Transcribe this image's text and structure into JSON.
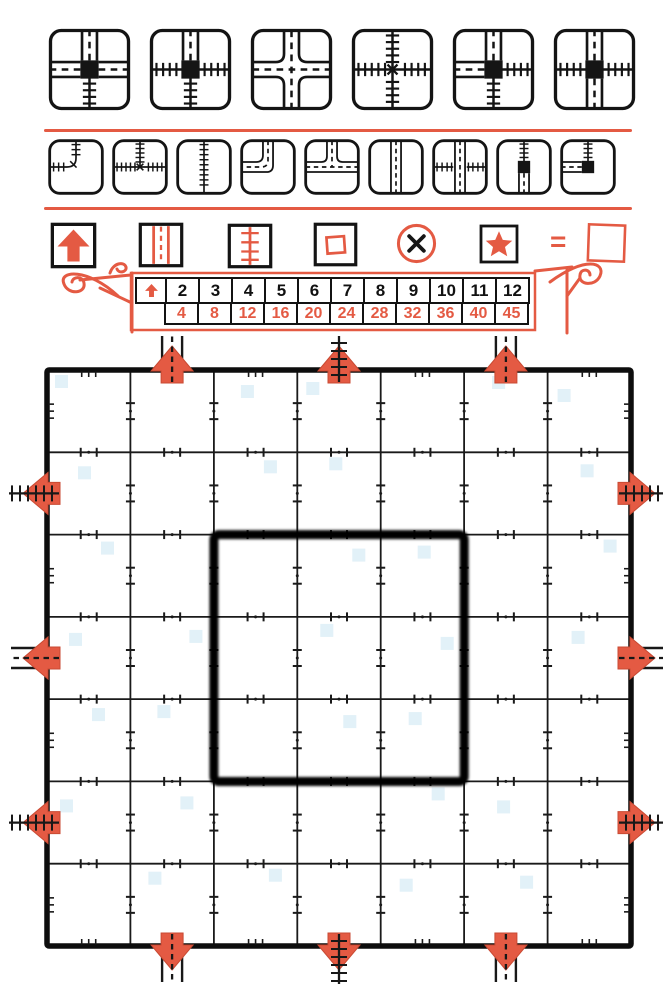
{
  "colors": {
    "red": "#e45a43",
    "red_dark": "#c94a33",
    "ink": "#141414",
    "artifact_blue": "#d6ebf5"
  },
  "labels": {
    "equals": "="
  },
  "special_tiles": [
    {
      "name": "station-3highway-1rail",
      "edges": {
        "top": "highway",
        "left": "highway",
        "right": "highway",
        "bottom": "rail"
      },
      "center": "station"
    },
    {
      "name": "station-1highway-3rail",
      "edges": {
        "top": "highway",
        "left": "rail",
        "right": "rail",
        "bottom": "rail"
      },
      "center": "station"
    },
    {
      "name": "highway-crossroad",
      "type": "hw-cross"
    },
    {
      "name": "rail-crossing",
      "type": "rail-cross"
    },
    {
      "name": "station-2highway-2rail-adjacent",
      "edges": {
        "top": "highway",
        "left": "highway",
        "right": "rail",
        "bottom": "rail"
      },
      "center": "station"
    },
    {
      "name": "station-2highway-2rail-opposite",
      "edges": {
        "top": "highway",
        "left": "rail",
        "right": "rail",
        "bottom": "highway"
      },
      "center": "station"
    }
  ],
  "dice_faces": [
    {
      "name": "rail-curve",
      "type": "rail-curve"
    },
    {
      "name": "rail-junction",
      "type": "rail-T"
    },
    {
      "name": "rail-straight",
      "type": "rail-straight"
    },
    {
      "name": "highway-curve",
      "type": "hw-curve"
    },
    {
      "name": "highway-junction",
      "type": "hw-T"
    },
    {
      "name": "highway-straight",
      "type": "hw-straight"
    },
    {
      "name": "overpass",
      "type": "overpass"
    },
    {
      "name": "station-straight",
      "edges": {
        "top": "rail",
        "bottom": "highway"
      },
      "center": "station"
    },
    {
      "name": "station-curve",
      "edges": {
        "top": "rail",
        "left": "highway"
      },
      "center": "station"
    }
  ],
  "legend_icons": [
    {
      "icon": "exit-arrow-icon"
    },
    {
      "icon": "highway-icon"
    },
    {
      "icon": "railway-icon"
    },
    {
      "icon": "empty-square-icon"
    },
    {
      "icon": "error-cross-icon"
    },
    {
      "icon": "star-icon"
    },
    {
      "icon": "blank-square-icon"
    }
  ],
  "score_table": {
    "header_icon": "exit-arrow-icon",
    "exits_connected": [
      "2",
      "3",
      "4",
      "5",
      "6",
      "7",
      "8",
      "9",
      "10",
      "11",
      "12"
    ],
    "points": [
      "4",
      "8",
      "12",
      "16",
      "20",
      "24",
      "28",
      "32",
      "36",
      "40",
      "45"
    ]
  },
  "board": {
    "rows": 7,
    "cols": 7,
    "center_bonus_area": "3x3",
    "exits": {
      "top": [
        "highway",
        "rail",
        "highway"
      ],
      "bottom": [
        "highway",
        "rail",
        "highway"
      ],
      "left": [
        "rail",
        "highway",
        "rail"
      ],
      "right": [
        "rail",
        "highway",
        "rail"
      ]
    }
  }
}
